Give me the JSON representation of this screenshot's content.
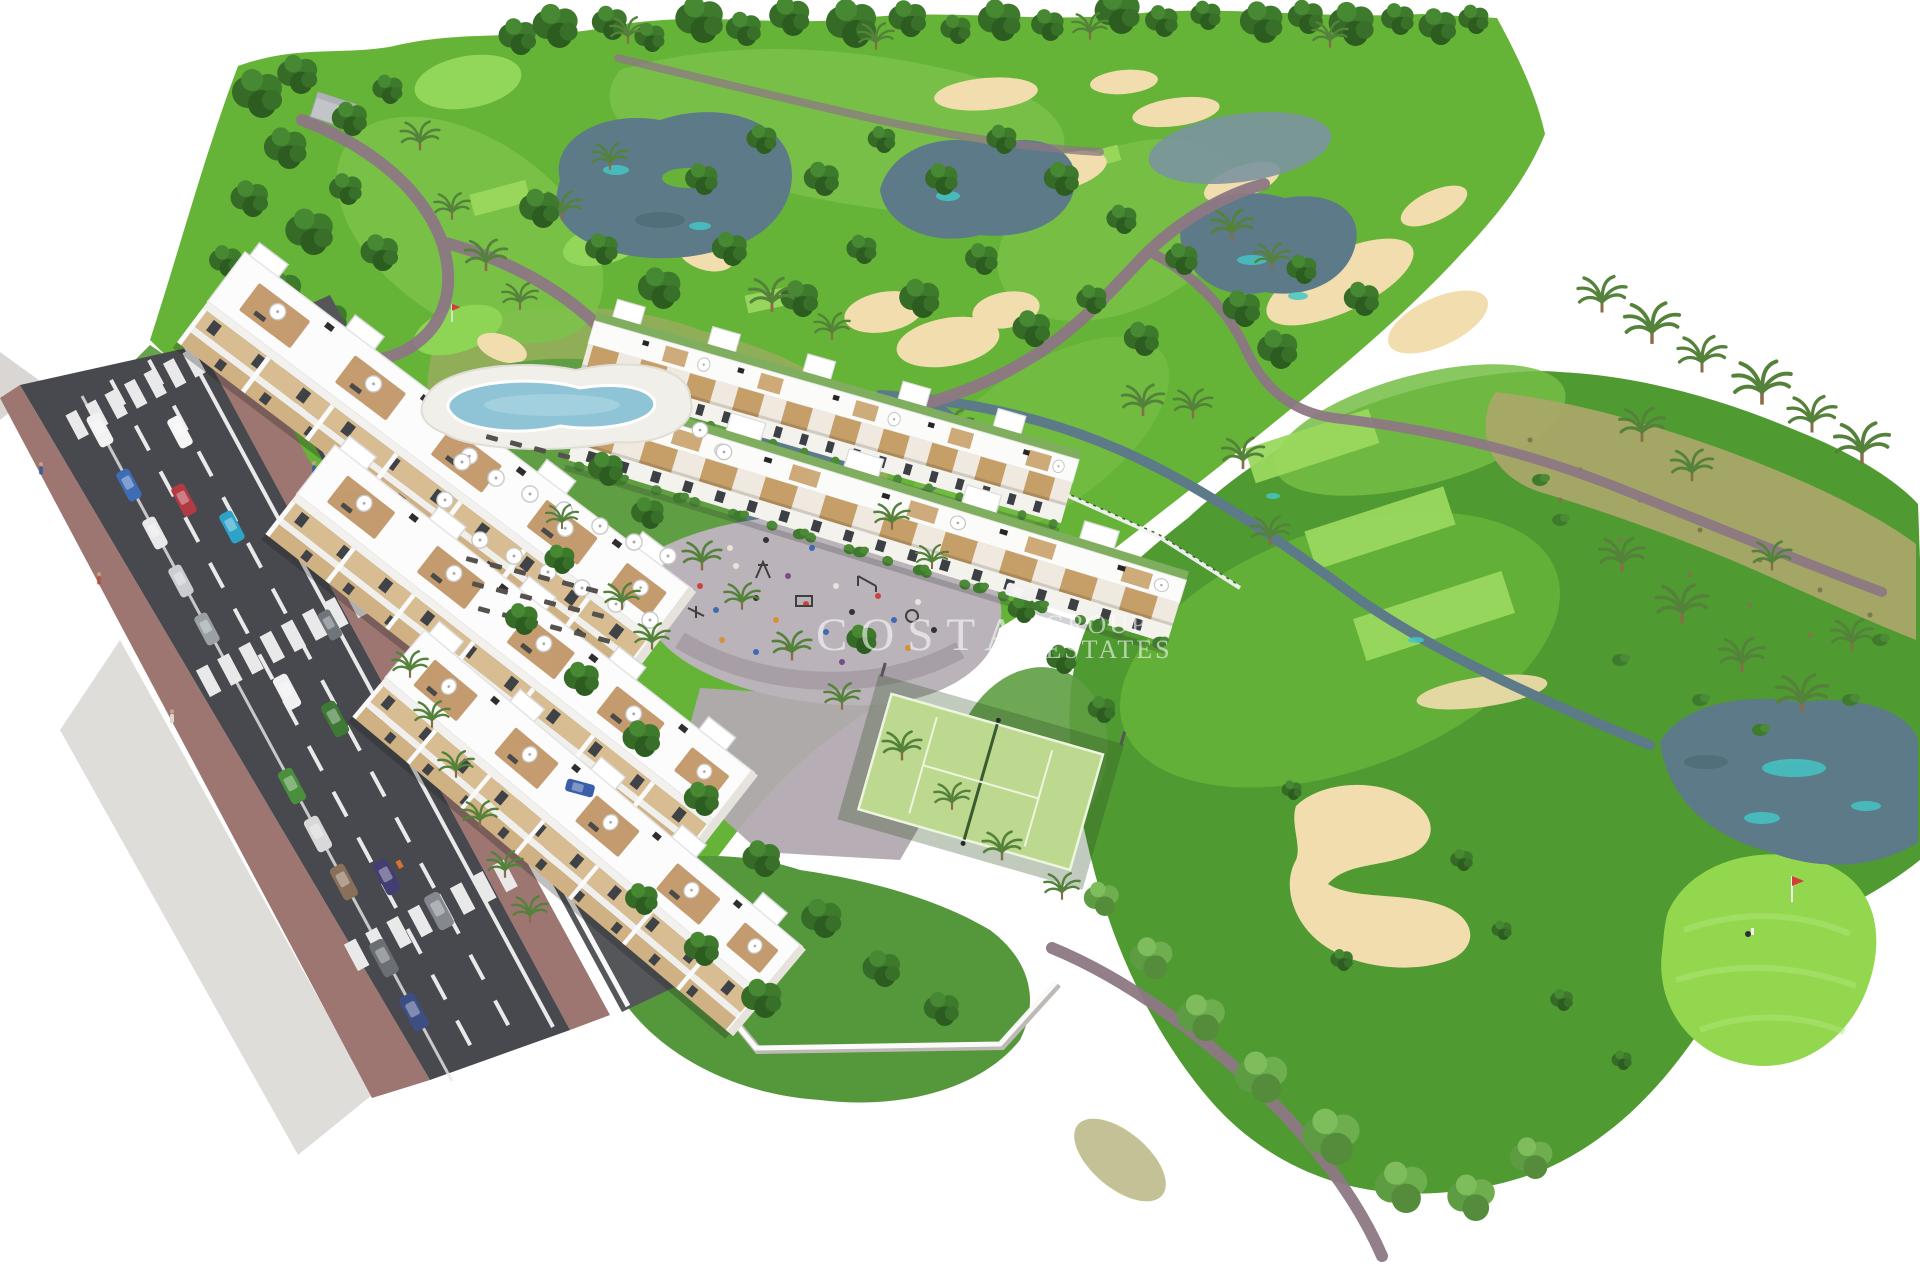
{
  "watermark": {
    "brand": "COSTA",
    "word_group": "GROUP",
    "word_estates": "ESTATES"
  },
  "scene": {
    "type": "aerial-architectural-render",
    "subject": "golf resort residential development with white apartment blocks, townhouse rows, pool, paddle court and golf course",
    "features": [
      "golf-course",
      "fairways",
      "sand-bunkers",
      "lakes",
      "stream",
      "putting-green",
      "tee-boxes",
      "palm-trees",
      "apartment-blocks",
      "townhouse-rows",
      "swimming-pool",
      "pool-umbrellas",
      "sun-loungers",
      "playground-plaza",
      "paddle-tennis-court",
      "access-road",
      "zebra-crossings",
      "parked-cars",
      "perimeter-walls",
      "pedestrians",
      "golfer",
      "flag"
    ]
  },
  "colors": {
    "background": "#ffffff",
    "fairway_green": "#65b437",
    "light_green": "#7cc24a",
    "tee_green": "#9ad95e",
    "dark_lawn": "#4f9a31",
    "scrub_olive": "#a9a768",
    "tree_green": "#2c5c20",
    "water_slate": "#5c7a88",
    "water_cyan": "#45c5c5",
    "sand": "#f2ddae",
    "cart_path_mauve": "#8d7884",
    "road_asphalt": "#47494e",
    "sidewalk_brick": "#9d7672",
    "building_white": "#fcfcfc",
    "building_tan": "#d9bd92",
    "pool_blue": "#8ec4d6",
    "court_green": "#bcd98f",
    "plaza_grey": "#b7aeb4",
    "watermark_white": "rgba(255,255,255,0.58)"
  }
}
